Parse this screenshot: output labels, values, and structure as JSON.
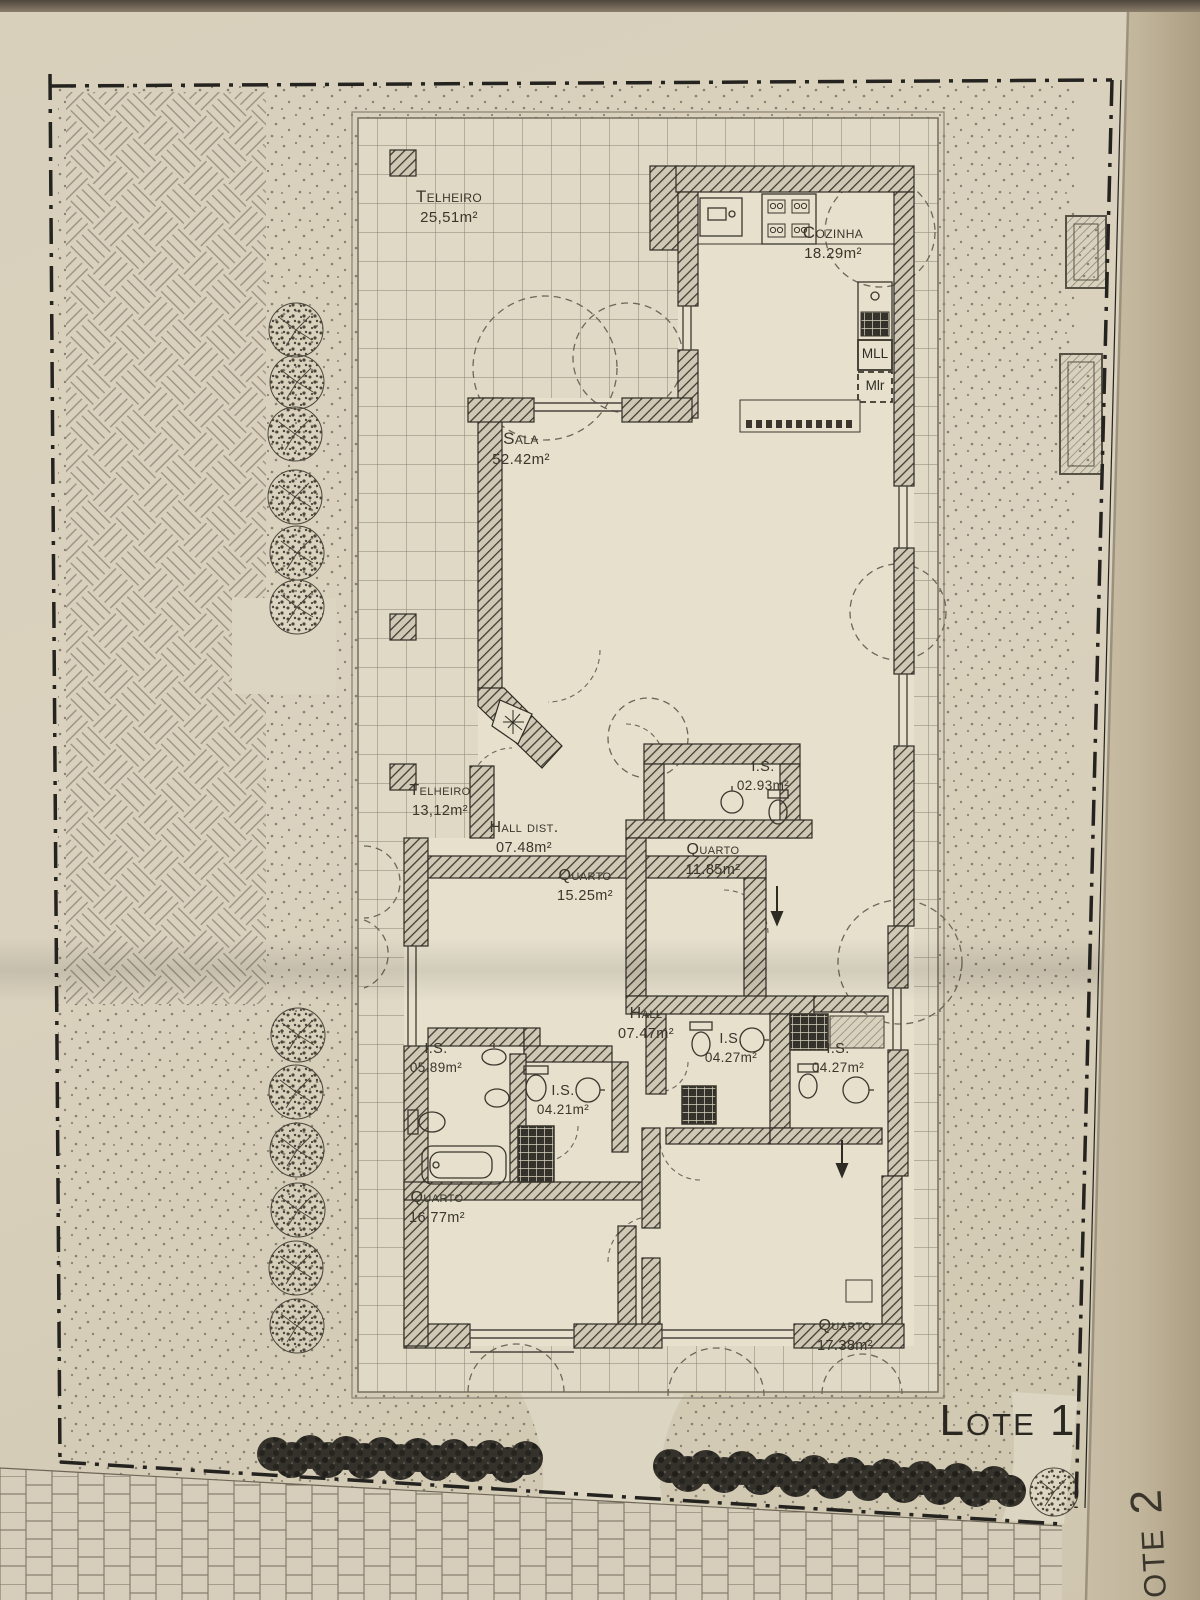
{
  "plan": {
    "rooms": [
      {
        "name": "Telheiro",
        "area": "25,51m²"
      },
      {
        "name": "Cozinha",
        "area": "18.29m²"
      },
      {
        "name": "Sala",
        "area": "52.42m²"
      },
      {
        "name": "Telheiro",
        "area": "13,12m²"
      },
      {
        "name": "Hall dist.",
        "area": "07.48m²"
      },
      {
        "name": "Quarto",
        "area": "15.25m²"
      },
      {
        "name": "I.S.",
        "area": "02.93m²"
      },
      {
        "name": "Quarto",
        "area": "11.85m²"
      },
      {
        "name": "Hall",
        "area": "07.47m²"
      },
      {
        "name": "I.S.",
        "area": "05.89m²"
      },
      {
        "name": "I.S.",
        "area": "04.21m²"
      },
      {
        "name": "I.S.",
        "area": "04.27m²"
      },
      {
        "name": "I.S.",
        "area": "04.27m²"
      },
      {
        "name": "Quarto",
        "area": "16.77m²"
      },
      {
        "name": "Quarto",
        "area": "17.38m²"
      }
    ],
    "appliances": [
      {
        "label": "MLL"
      },
      {
        "label": "Mlr"
      }
    ],
    "lots": [
      {
        "label": "Lote 1"
      },
      {
        "label": "Lote 2"
      }
    ]
  }
}
